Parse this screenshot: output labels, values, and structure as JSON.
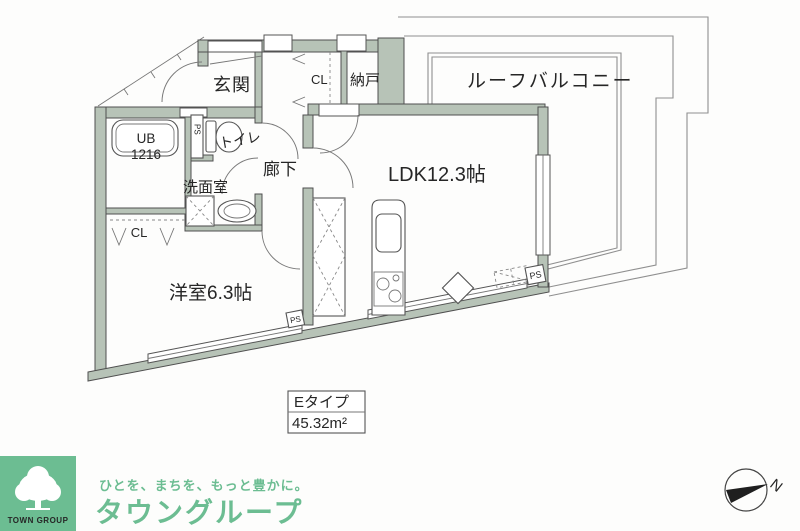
{
  "plan": {
    "labels": {
      "genkan": "玄関",
      "cl_upper": "CL",
      "nando": "納戸",
      "roof_balcony": "ルーフバルコニー",
      "toilet": "トイレ",
      "ub": "UB",
      "ub_size": "1216",
      "ps": "PS",
      "rouka": "廊下",
      "senmenshitsu": "洗面室",
      "ldk": "LDK12.3帖",
      "yoshitsu": "洋室6.3帖",
      "cl_lower": "CL"
    },
    "type_box": {
      "type": "Eタイプ",
      "area": "45.32m²"
    },
    "colors": {
      "wall_fill": "#b7c3b7",
      "wall_stroke": "#4f4f4f",
      "balcony_line": "#8f8f8f"
    }
  },
  "footer": {
    "logo_square_label": "TOWN GROUP",
    "tagline": "ひとを、まちを、もっと豊かに。",
    "brand": "タウングループ",
    "brand_green": "#6cbd92"
  },
  "compass": {
    "north_label": "N"
  }
}
